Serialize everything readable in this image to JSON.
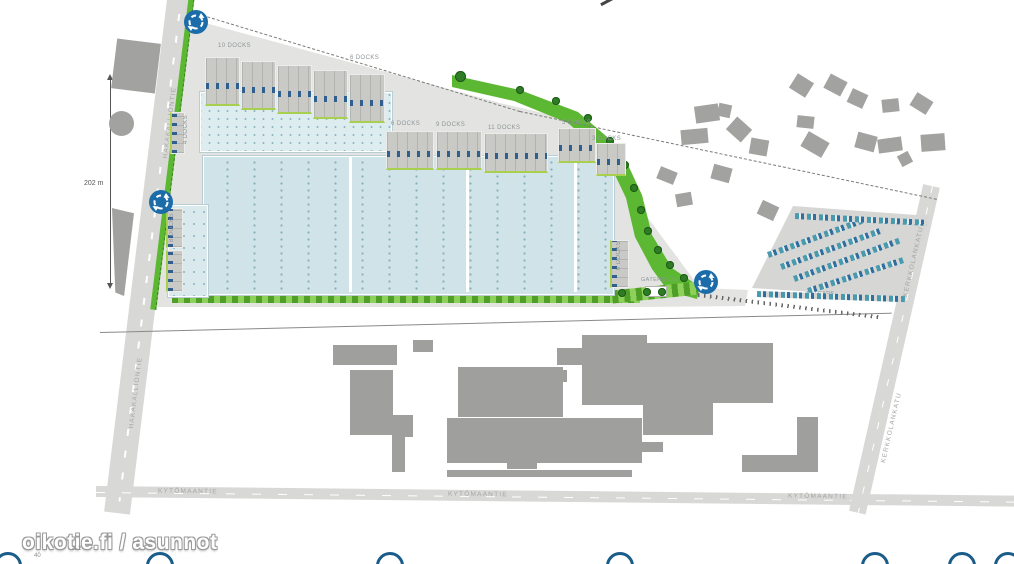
{
  "page": {
    "watermark": "oikotie.fi / asunnot",
    "footnote_a": "A-2",
    "footnote_b": "40"
  },
  "dimension": {
    "label": "202 m"
  },
  "roads": {
    "bottom_name": "KYTÖMAANTIE",
    "left_name": "HAKAKALLIONTIE",
    "right_name": "KERKKOLANKATU"
  },
  "site": {
    "gatehouse_label": "GATEHOUSE"
  },
  "parking": {
    "label": "100 CARS",
    "rows": [
      [
        768,
        252,
        100,
        -20
      ],
      [
        781,
        264,
        108,
        -20
      ],
      [
        794,
        276,
        112,
        -20
      ],
      [
        808,
        288,
        100,
        -18
      ],
      [
        795,
        213,
        132,
        3
      ],
      [
        757,
        291,
        148,
        2
      ]
    ]
  },
  "docks": {
    "labels": [
      {
        "t": "10 DOCKS",
        "x": 218,
        "y": 43
      },
      {
        "t": "6 DOCKS",
        "x": 350,
        "y": 55
      },
      {
        "t": "6 DOCKS",
        "x": 391,
        "y": 121
      },
      {
        "t": "9 DOCKS",
        "x": 436,
        "y": 122
      },
      {
        "t": "11 DOCKS",
        "x": 488,
        "y": 125
      },
      {
        "t": "5 DOCKS",
        "x": 562,
        "y": 120
      },
      {
        "t": "3 DOCKS",
        "x": 592,
        "y": 136
      },
      {
        "t": "8 DOCKS",
        "x": 169,
        "y": 213,
        "v": 1
      },
      {
        "t": "4 DOCKS",
        "x": 183,
        "y": 115,
        "v": 1
      },
      {
        "t": "6 DOCKS",
        "x": 616,
        "y": 241,
        "v": 1
      }
    ],
    "blocks": [
      [
        205,
        57,
        33,
        46
      ],
      [
        241,
        61,
        33,
        46
      ],
      [
        277,
        65,
        33,
        46
      ],
      [
        313,
        70,
        33,
        46
      ],
      [
        349,
        74,
        34,
        46
      ],
      [
        386,
        131,
        46,
        36
      ],
      [
        436,
        131,
        44,
        36
      ],
      [
        484,
        133,
        62,
        37
      ],
      [
        558,
        128,
        36,
        32
      ],
      [
        596,
        143,
        28,
        30
      ],
      {
        "x": 610,
        "y": 240,
        "w": 16,
        "h": 46,
        "v": 1
      },
      {
        "x": 166,
        "y": 208,
        "w": 14,
        "h": 38,
        "v": 1
      },
      {
        "x": 166,
        "y": 250,
        "w": 14,
        "h": 40,
        "v": 1
      },
      {
        "x": 170,
        "y": 112,
        "w": 12,
        "h": 40,
        "v": 1
      }
    ]
  },
  "shapes": {
    "houses": [
      [
        695,
        105,
        24,
        17,
        -8
      ],
      [
        718,
        104,
        13,
        13,
        12
      ],
      [
        681,
        129,
        27,
        15,
        -5
      ],
      [
        729,
        121,
        20,
        17,
        42
      ],
      [
        750,
        139,
        18,
        16,
        10
      ],
      [
        658,
        169,
        18,
        13,
        22
      ],
      [
        712,
        166,
        19,
        15,
        15
      ],
      [
        676,
        193,
        16,
        13,
        -10
      ],
      [
        759,
        203,
        18,
        15,
        25
      ],
      [
        792,
        77,
        19,
        17,
        32
      ],
      [
        826,
        77,
        19,
        16,
        28
      ],
      [
        797,
        116,
        17,
        12,
        6
      ],
      [
        803,
        136,
        24,
        17,
        30
      ],
      [
        849,
        91,
        17,
        15,
        25
      ],
      [
        856,
        134,
        20,
        16,
        15
      ],
      [
        882,
        99,
        17,
        13,
        -6
      ],
      [
        878,
        138,
        24,
        14,
        -8
      ],
      [
        912,
        96,
        19,
        15,
        32
      ],
      [
        921,
        134,
        24,
        17,
        -4
      ],
      [
        899,
        153,
        12,
        12,
        -28
      ]
    ],
    "industrial": [
      [
        333,
        345,
        64,
        20
      ],
      [
        413,
        340,
        20,
        12
      ],
      [
        350,
        370,
        43,
        65
      ],
      [
        392,
        415,
        21,
        22
      ],
      [
        392,
        437,
        13,
        35
      ],
      [
        458,
        367,
        105,
        50
      ],
      [
        540,
        370,
        27,
        12
      ],
      [
        447,
        418,
        195,
        45
      ],
      [
        642,
        442,
        21,
        10
      ],
      [
        507,
        463,
        30,
        6
      ],
      [
        582,
        335,
        65,
        70
      ],
      [
        557,
        348,
        25,
        17
      ],
      [
        647,
        343,
        126,
        60
      ],
      [
        643,
        403,
        70,
        32
      ],
      [
        742,
        455,
        76,
        17
      ],
      [
        797,
        417,
        21,
        55
      ],
      [
        447,
        470,
        185,
        7
      ]
    ],
    "trees": [
      [
        460,
        76,
        11
      ],
      [
        520,
        90,
        8
      ],
      [
        556,
        101,
        8
      ],
      [
        588,
        118,
        8
      ],
      [
        610,
        141,
        8
      ],
      [
        625,
        165,
        8
      ],
      [
        634,
        188,
        8
      ],
      [
        641,
        210,
        8
      ],
      [
        648,
        231,
        8
      ],
      [
        658,
        250,
        8
      ],
      [
        670,
        265,
        8
      ],
      [
        684,
        278,
        8
      ],
      [
        622,
        293,
        8
      ],
      [
        647,
        292,
        8
      ],
      [
        662,
        292,
        8
      ]
    ],
    "roundabouts": [
      [
        183,
        9
      ],
      [
        148,
        189
      ],
      [
        693,
        269
      ]
    ]
  },
  "footer": {
    "circle_centers_x": [
      8,
      160,
      390,
      620,
      875,
      962,
      1008
    ]
  },
  "colors": {
    "roundabout_blue": "#1b6ca8",
    "building_fill": "#cfe3e8",
    "green": "#5cb832",
    "pavement": "#e3e3e1",
    "road": "#d8d8d6",
    "gray_building": "#9f9f9d",
    "footer_circle_blue": "#1a5c8a"
  }
}
